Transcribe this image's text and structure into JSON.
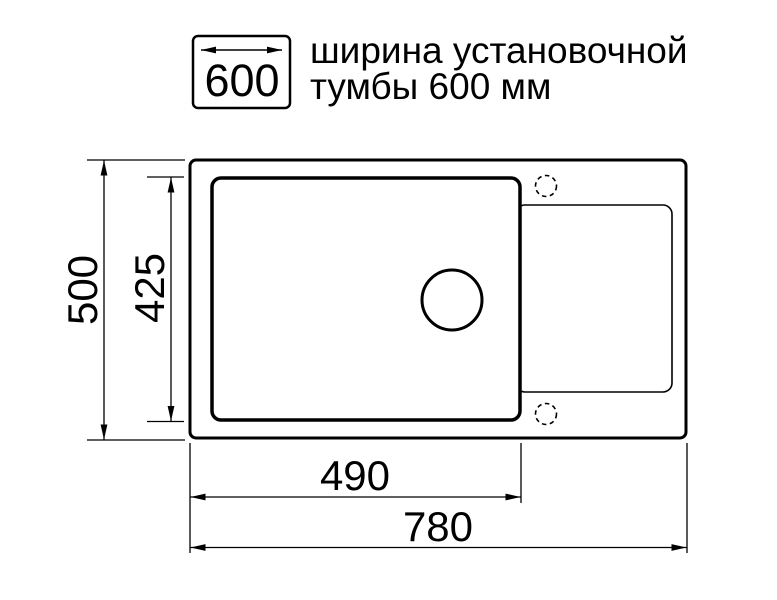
{
  "legend": {
    "box_value": "600",
    "label_line1": "ширина установочной",
    "label_line2": "тумбы 600 мм"
  },
  "dimensions": {
    "overall_height": "500",
    "bowl_height": "425",
    "bowl_width": "490",
    "overall_width": "780"
  },
  "colors": {
    "line": "#000000",
    "background": "#ffffff"
  }
}
